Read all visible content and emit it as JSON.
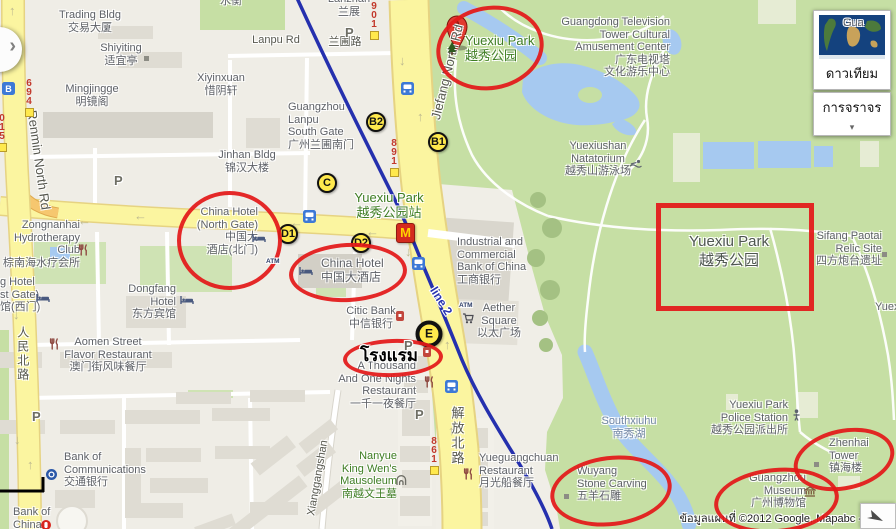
{
  "controls": {
    "satellite_label": "ดาวเทียม",
    "traffic_label": "การจราจร"
  },
  "attribution": {
    "text": "ข้อมูลแผนที่ ©2012 Google, Mapabc -"
  },
  "colors": {
    "park_green": "#C6DFA4",
    "water_blue": "#A6C9F0",
    "road_yellow": "#FBF5A0",
    "metro_blue": "#2530AE",
    "annotation_red": "#E31919",
    "marker_yellow": "#FFE94D"
  },
  "icon_glyphs": {
    "parking": "P",
    "atm": "ATM",
    "metro_station": "B",
    "mcdonalds": "M",
    "arrow_left": "←",
    "arrow_up": "↑",
    "arrow_down": "↓",
    "traffic_chevron": "▾",
    "panel_chevron": "›",
    "satellite_thumbnail": "world-map",
    "nav_arrow": "navigate-arrow"
  },
  "markers": {
    "pin_a": {
      "letter": "A",
      "x": 446,
      "y": 15
    },
    "badges": [
      {
        "l": "B2",
        "x": 376,
        "y": 122
      },
      {
        "l": "B1",
        "x": 438,
        "y": 142
      },
      {
        "l": "C",
        "x": 327,
        "y": 183
      },
      {
        "l": "D1",
        "x": 288,
        "y": 234
      },
      {
        "l": "D2",
        "x": 361,
        "y": 243
      },
      {
        "l": "E",
        "x": 429,
        "y": 334,
        "big": true
      }
    ]
  },
  "road_badges": [
    {
      "num": "901",
      "x": 368,
      "y": 2
    },
    {
      "num": "891",
      "x": 388,
      "y": 139
    },
    {
      "num": "861",
      "x": 428,
      "y": 437
    },
    {
      "num": "694",
      "x": 23,
      "y": 79
    },
    {
      "num": "015",
      "x": -4,
      "y": 114
    }
  ],
  "annotations": {
    "hotel_note": {
      "text": "โรงแรม",
      "x": 389,
      "y": 342
    },
    "rectangle": {
      "n": "rect-yuexiu-park",
      "x": 656,
      "y": 203,
      "w": 148,
      "h": 98
    },
    "ellipses": [
      {
        "n": "circle-yuexiu-park-entrance",
        "x": 436,
        "y": 6,
        "w": 100,
        "h": 76,
        "rot": -10
      },
      {
        "n": "circle-china-hotel-north-gate",
        "x": 177,
        "y": 191,
        "w": 97,
        "h": 91,
        "rot": 0
      },
      {
        "n": "circle-china-hotel",
        "x": 289,
        "y": 243,
        "w": 110,
        "h": 51,
        "rot": -3
      },
      {
        "n": "circle-hotel-thai",
        "x": 343,
        "y": 339,
        "w": 92,
        "h": 30,
        "rot": -2
      },
      {
        "n": "circle-wuyang-stone-carving",
        "x": 550,
        "y": 456,
        "w": 114,
        "h": 62,
        "rot": -7
      },
      {
        "n": "circle-guangzhou-museum",
        "x": 714,
        "y": 468,
        "w": 117,
        "h": 57,
        "rot": -5
      },
      {
        "n": "circle-zhenhai-tower",
        "x": 793,
        "y": 429,
        "w": 94,
        "h": 53,
        "rot": -12
      }
    ]
  },
  "labels": [
    {
      "n": "shuiheng",
      "x": 231,
      "y": -5,
      "a": "c",
      "lines": [
        "水衡"
      ]
    },
    {
      "n": "trading-bldg",
      "x": 90,
      "y": 9,
      "a": "c",
      "lines": [
        "Trading Bldg",
        "交易大厦"
      ]
    },
    {
      "n": "lanzhan",
      "x": 349,
      "y": -7,
      "a": "c",
      "lines": [
        "Lanzhan",
        "兰展"
      ]
    },
    {
      "n": "shiyiting",
      "x": 121,
      "y": 42,
      "a": "c",
      "lines": [
        "Shiyiting",
        "适宜亭"
      ]
    },
    {
      "n": "mingjingge",
      "x": 92,
      "y": 83,
      "a": "c",
      "lines": [
        "Mingjingge",
        "明镜阁"
      ]
    },
    {
      "n": "xiyinxuan",
      "x": 221,
      "y": 72,
      "a": "c",
      "lines": [
        "Xiyinxuan",
        "惜阴轩"
      ]
    },
    {
      "n": "lanpu-rd",
      "x": 276,
      "y": 34,
      "a": "c",
      "cls": "road",
      "lines": [
        "Lanpu Rd"
      ]
    },
    {
      "n": "lanpu-rd-cn",
      "x": 345,
      "y": 36,
      "a": "c",
      "cls": "road",
      "lines": [
        "兰圃路"
      ]
    },
    {
      "n": "jinhan-bldg",
      "x": 247,
      "y": 149,
      "a": "c",
      "lines": [
        "Jinhan Bldg",
        "锦汉大楼"
      ]
    },
    {
      "n": "lanpu-south-gate",
      "x": 288,
      "y": 101,
      "a": "l",
      "lines": [
        "Guangzhou",
        "Lanpu",
        "South Gate",
        "广州兰圃南门"
      ]
    },
    {
      "n": "guangdong-tv-center",
      "x": 670,
      "y": 16,
      "a": "r",
      "lines": [
        "Guangdong Television",
        "Tower Cultural",
        "Amusement Center",
        "广东电视塔",
        "文化游乐中心"
      ]
    },
    {
      "n": "yuexiushan-natatorium",
      "x": 598,
      "y": 140,
      "a": "c",
      "lines": [
        "Yuexiushan",
        "Natatorium",
        "越秀山游泳场"
      ]
    },
    {
      "n": "pin-a-label",
      "x": 465,
      "y": 33,
      "a": "l",
      "cls": "green sz13",
      "lines": [
        "Yuexiu Park",
        "越秀公园"
      ]
    },
    {
      "n": "station-label",
      "x": 389,
      "y": 190,
      "a": "c",
      "cls": "green sz13",
      "lines": [
        "Yuexiu Park",
        "越秀公园站"
      ]
    },
    {
      "n": "zongnanhai-hydrotherapy",
      "x": 80,
      "y": 219,
      "a": "r",
      "lines": [
        "Zongnanhai",
        "Hydrotherapy",
        "Club",
        "棕南海水疗会所"
      ]
    },
    {
      "n": "china-hotel-north-gate",
      "x": 258,
      "y": 206,
      "a": "r",
      "lines": [
        "China Hotel",
        "(North Gate)",
        "中国大",
        "酒店(北门)"
      ]
    },
    {
      "n": "dongfang-hotel",
      "x": 176,
      "y": 283,
      "a": "r",
      "lines": [
        "Dongfang",
        "Hotel",
        "东方宾馆"
      ]
    },
    {
      "n": "hotel-west-gate-partial",
      "x": 0,
      "y": 276,
      "a": "l",
      "lines": [
        "g Hotel",
        "st Gate)",
        "馆(西门)"
      ]
    },
    {
      "n": "china-hotel",
      "x": 321,
      "y": 257,
      "a": "l",
      "cls": "sz12",
      "lines": [
        "China Hotel",
        "中国大酒店"
      ]
    },
    {
      "n": "aomen-flavor-restaurant",
      "x": 108,
      "y": 336,
      "a": "c",
      "lines": [
        "Aomen Street",
        "Flavor Restaurant",
        "澳门街风味餐厅"
      ]
    },
    {
      "n": "citic-bank",
      "x": 371,
      "y": 305,
      "a": "c",
      "lines": [
        "Citic Bank",
        "中信银行"
      ]
    },
    {
      "n": "icbc",
      "x": 457,
      "y": 236,
      "a": "l",
      "lines": [
        "Industrial and",
        "Commercial",
        "Bank of China",
        "工商银行"
      ]
    },
    {
      "n": "aether-square",
      "x": 499,
      "y": 302,
      "a": "c",
      "lines": [
        "Aether",
        "Square",
        "以太广场"
      ]
    },
    {
      "n": "renmin-north-rd",
      "x": 39,
      "y": 160,
      "rot": 82,
      "cls": "road sz13",
      "lines": [
        "Renmin North Rd"
      ]
    },
    {
      "n": "renmin-north-rd-cn",
      "x": 22,
      "y": 326,
      "a": "c",
      "cls": "vert sz12 road",
      "lines": [
        "人民北路"
      ]
    },
    {
      "n": "jiefang-north-rd",
      "x": 447,
      "y": 72,
      "rot": -76,
      "cls": "road sz13",
      "lines": [
        "Jiefang North Rd"
      ]
    },
    {
      "n": "jiefang-north-rd-cn",
      "x": 457,
      "y": 406,
      "a": "c",
      "cls": "vert sz13 road",
      "lines": [
        "解放北路"
      ]
    },
    {
      "n": "metro-line2",
      "x": 441,
      "y": 301,
      "rot": 58,
      "cls": "metro",
      "lines": [
        "line 2"
      ]
    },
    {
      "n": "xianggangshan-rd",
      "x": 318,
      "y": 478,
      "rot": -80,
      "cls": "road",
      "lines": [
        "Xianggangshan"
      ]
    },
    {
      "n": "thousand-nights-restaurant",
      "x": 416,
      "y": 360,
      "a": "r",
      "lines": [
        "A Thousand",
        "And One Nights",
        "Restaurant",
        "一千一夜餐厅"
      ]
    },
    {
      "n": "nanyue-mausoleum",
      "x": 397,
      "y": 450,
      "a": "r",
      "cls": "green",
      "lines": [
        "Nanyue",
        "King Wen's",
        "Mausoleum",
        "南越文王墓"
      ]
    },
    {
      "n": "yueguangchuan-restaurant",
      "x": 479,
      "y": 452,
      "a": "l",
      "lines": [
        "Yueguangchuan",
        "Restaurant",
        "月光船餐厅"
      ]
    },
    {
      "n": "southxiuhu",
      "x": 629,
      "y": 415,
      "a": "c",
      "cls": "water",
      "lines": [
        "Southxiuhu",
        "南秀湖"
      ]
    },
    {
      "n": "yuexiu-police-station",
      "x": 788,
      "y": 399,
      "a": "r",
      "lines": [
        "Yuexiu Park",
        "Police Station",
        "越秀公园派出所"
      ]
    },
    {
      "n": "wuyang-stone-carving",
      "x": 577,
      "y": 465,
      "a": "l",
      "lines": [
        "Wuyang",
        "Stone Carving",
        "五羊石雕"
      ]
    },
    {
      "n": "guangzhou-museum",
      "x": 806,
      "y": 472,
      "a": "r",
      "lines": [
        "Guangzhou",
        "Museum",
        "广州博物馆"
      ]
    },
    {
      "n": "zhenhai-tower",
      "x": 829,
      "y": 437,
      "a": "l",
      "lines": [
        "Zhenhai",
        "Tower",
        "镇海楼"
      ]
    },
    {
      "n": "sifang-paotai",
      "x": 882,
      "y": 230,
      "a": "r",
      "lines": [
        "Sifang Paotai",
        "Relic Site",
        "四方炮台遗址"
      ]
    },
    {
      "n": "yuexiu-park-name",
      "x": 729,
      "y": 232,
      "a": "c",
      "cls": "parkname",
      "lines": [
        "Yuexiu Park",
        "越秀公园"
      ]
    },
    {
      "n": "yuex-partial",
      "x": 875,
      "y": 301,
      "a": "l",
      "lines": [
        "Yuex"
      ]
    },
    {
      "n": "gua-partial",
      "x": 843,
      "y": 17,
      "a": "l",
      "lines": [
        "Gua"
      ]
    },
    {
      "n": "bank-of-communications",
      "x": 64,
      "y": 451,
      "a": "l",
      "lines": [
        "Bank of",
        "Communications",
        "交通银行"
      ]
    },
    {
      "n": "bank-of-china",
      "x": 13,
      "y": 506,
      "a": "l",
      "lines": [
        "Bank of",
        "China"
      ]
    }
  ],
  "icons": [
    {
      "t": "parking",
      "x": 345,
      "y": 24
    },
    {
      "t": "parking",
      "x": 114,
      "y": 172
    },
    {
      "t": "parking",
      "x": 32,
      "y": 408
    },
    {
      "t": "parking",
      "x": 415,
      "y": 406
    },
    {
      "t": "parking",
      "x": 404,
      "y": 337
    },
    {
      "t": "atm",
      "x": 266,
      "y": 250
    },
    {
      "t": "atm",
      "x": 459,
      "y": 294
    },
    {
      "t": "bus",
      "x": 401,
      "y": 82
    },
    {
      "t": "bus",
      "x": 303,
      "y": 210
    },
    {
      "t": "bus",
      "x": 412,
      "y": 257
    },
    {
      "t": "bus",
      "x": 445,
      "y": 380
    },
    {
      "t": "metro",
      "x": 2,
      "y": 82
    },
    {
      "t": "restaurant",
      "x": 78,
      "y": 243
    },
    {
      "t": "restaurant",
      "x": 49,
      "y": 337
    },
    {
      "t": "restaurant",
      "x": 424,
      "y": 375
    },
    {
      "t": "restaurant",
      "x": 463,
      "y": 467
    },
    {
      "t": "hotel",
      "x": 252,
      "y": 230
    },
    {
      "t": "hotel",
      "x": 299,
      "y": 263
    },
    {
      "t": "hotel",
      "x": 180,
      "y": 292
    },
    {
      "t": "hotel",
      "x": 36,
      "y": 290
    },
    {
      "t": "cart",
      "x": 462,
      "y": 311
    },
    {
      "t": "museum",
      "x": 804,
      "y": 484
    },
    {
      "t": "police",
      "x": 792,
      "y": 408
    },
    {
      "t": "swim",
      "x": 629,
      "y": 155
    },
    {
      "t": "sqdot",
      "x": 144,
      "y": 48
    },
    {
      "t": "sqdot",
      "x": 564,
      "y": 486
    },
    {
      "t": "sqdot",
      "x": 814,
      "y": 454
    },
    {
      "t": "sqdot",
      "x": 882,
      "y": 244
    },
    {
      "t": "mausoleum",
      "x": 396,
      "y": 472
    },
    {
      "t": "boc",
      "x": 41,
      "y": 517
    },
    {
      "t": "bocom",
      "x": 46,
      "y": 467
    },
    {
      "t": "redpoi",
      "x": 423,
      "y": 344
    },
    {
      "t": "redpoi",
      "x": 396,
      "y": 308
    },
    {
      "t": "tree",
      "x": 447,
      "y": 42
    },
    {
      "t": "arrow-left",
      "x": 78,
      "y": 212
    },
    {
      "t": "arrow-left",
      "x": 134,
      "y": 207
    },
    {
      "t": "arrow-left",
      "x": 290,
      "y": 214
    },
    {
      "t": "arrow-left",
      "x": 366,
      "y": 223
    },
    {
      "t": "arrow-down",
      "x": 399,
      "y": 52
    },
    {
      "t": "arrow-down",
      "x": 405,
      "y": 243
    },
    {
      "t": "arrow-down",
      "x": 13,
      "y": 306
    },
    {
      "t": "arrow-down",
      "x": 14,
      "y": 431
    },
    {
      "t": "arrow-up",
      "x": 417,
      "y": 108
    },
    {
      "t": "arrow-up",
      "x": 444,
      "y": 336
    },
    {
      "t": "arrow-up",
      "x": 448,
      "y": 422
    },
    {
      "t": "arrow-up",
      "x": 9,
      "y": 2
    },
    {
      "t": "arrow-up",
      "x": 27,
      "y": 456
    }
  ]
}
